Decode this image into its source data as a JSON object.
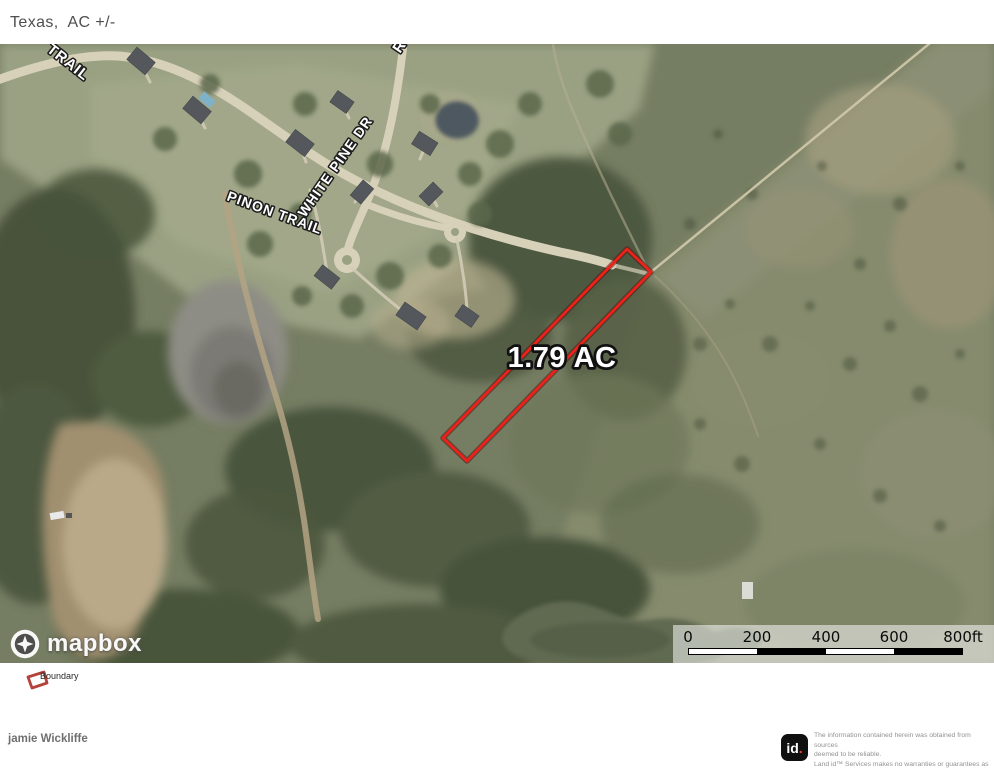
{
  "header": {
    "title": "Texas,  AC +/-"
  },
  "map": {
    "street_labels": [
      {
        "text": "TRAIL"
      },
      {
        "text": "PINON TRAIL"
      },
      {
        "text": "WHITE PINE DR"
      },
      {
        "text": "R"
      }
    ],
    "parcel": {
      "area_label": "1.79 AC",
      "boundary_color": "#ed201a"
    },
    "scale_bar": {
      "ticks": [
        "0",
        "200",
        "400",
        "600",
        "800ft"
      ]
    },
    "attribution": {
      "brand": "mapbox"
    }
  },
  "legend": {
    "items": [
      {
        "label": "Boundary",
        "swatch_color": "#b5423a"
      }
    ]
  },
  "footer": {
    "author": "jamie Wickliffe",
    "provider": {
      "logo_text": "id",
      "logo_dot": ".",
      "accent_red": "#e8403a",
      "disclaimer_lines": [
        "The information contained herein was obtained from sources",
        "deemed to be reliable.",
        " Land id™ Services makes no warranties or guarantees as to the",
        "completeness or accuracy thereof"
      ]
    }
  }
}
